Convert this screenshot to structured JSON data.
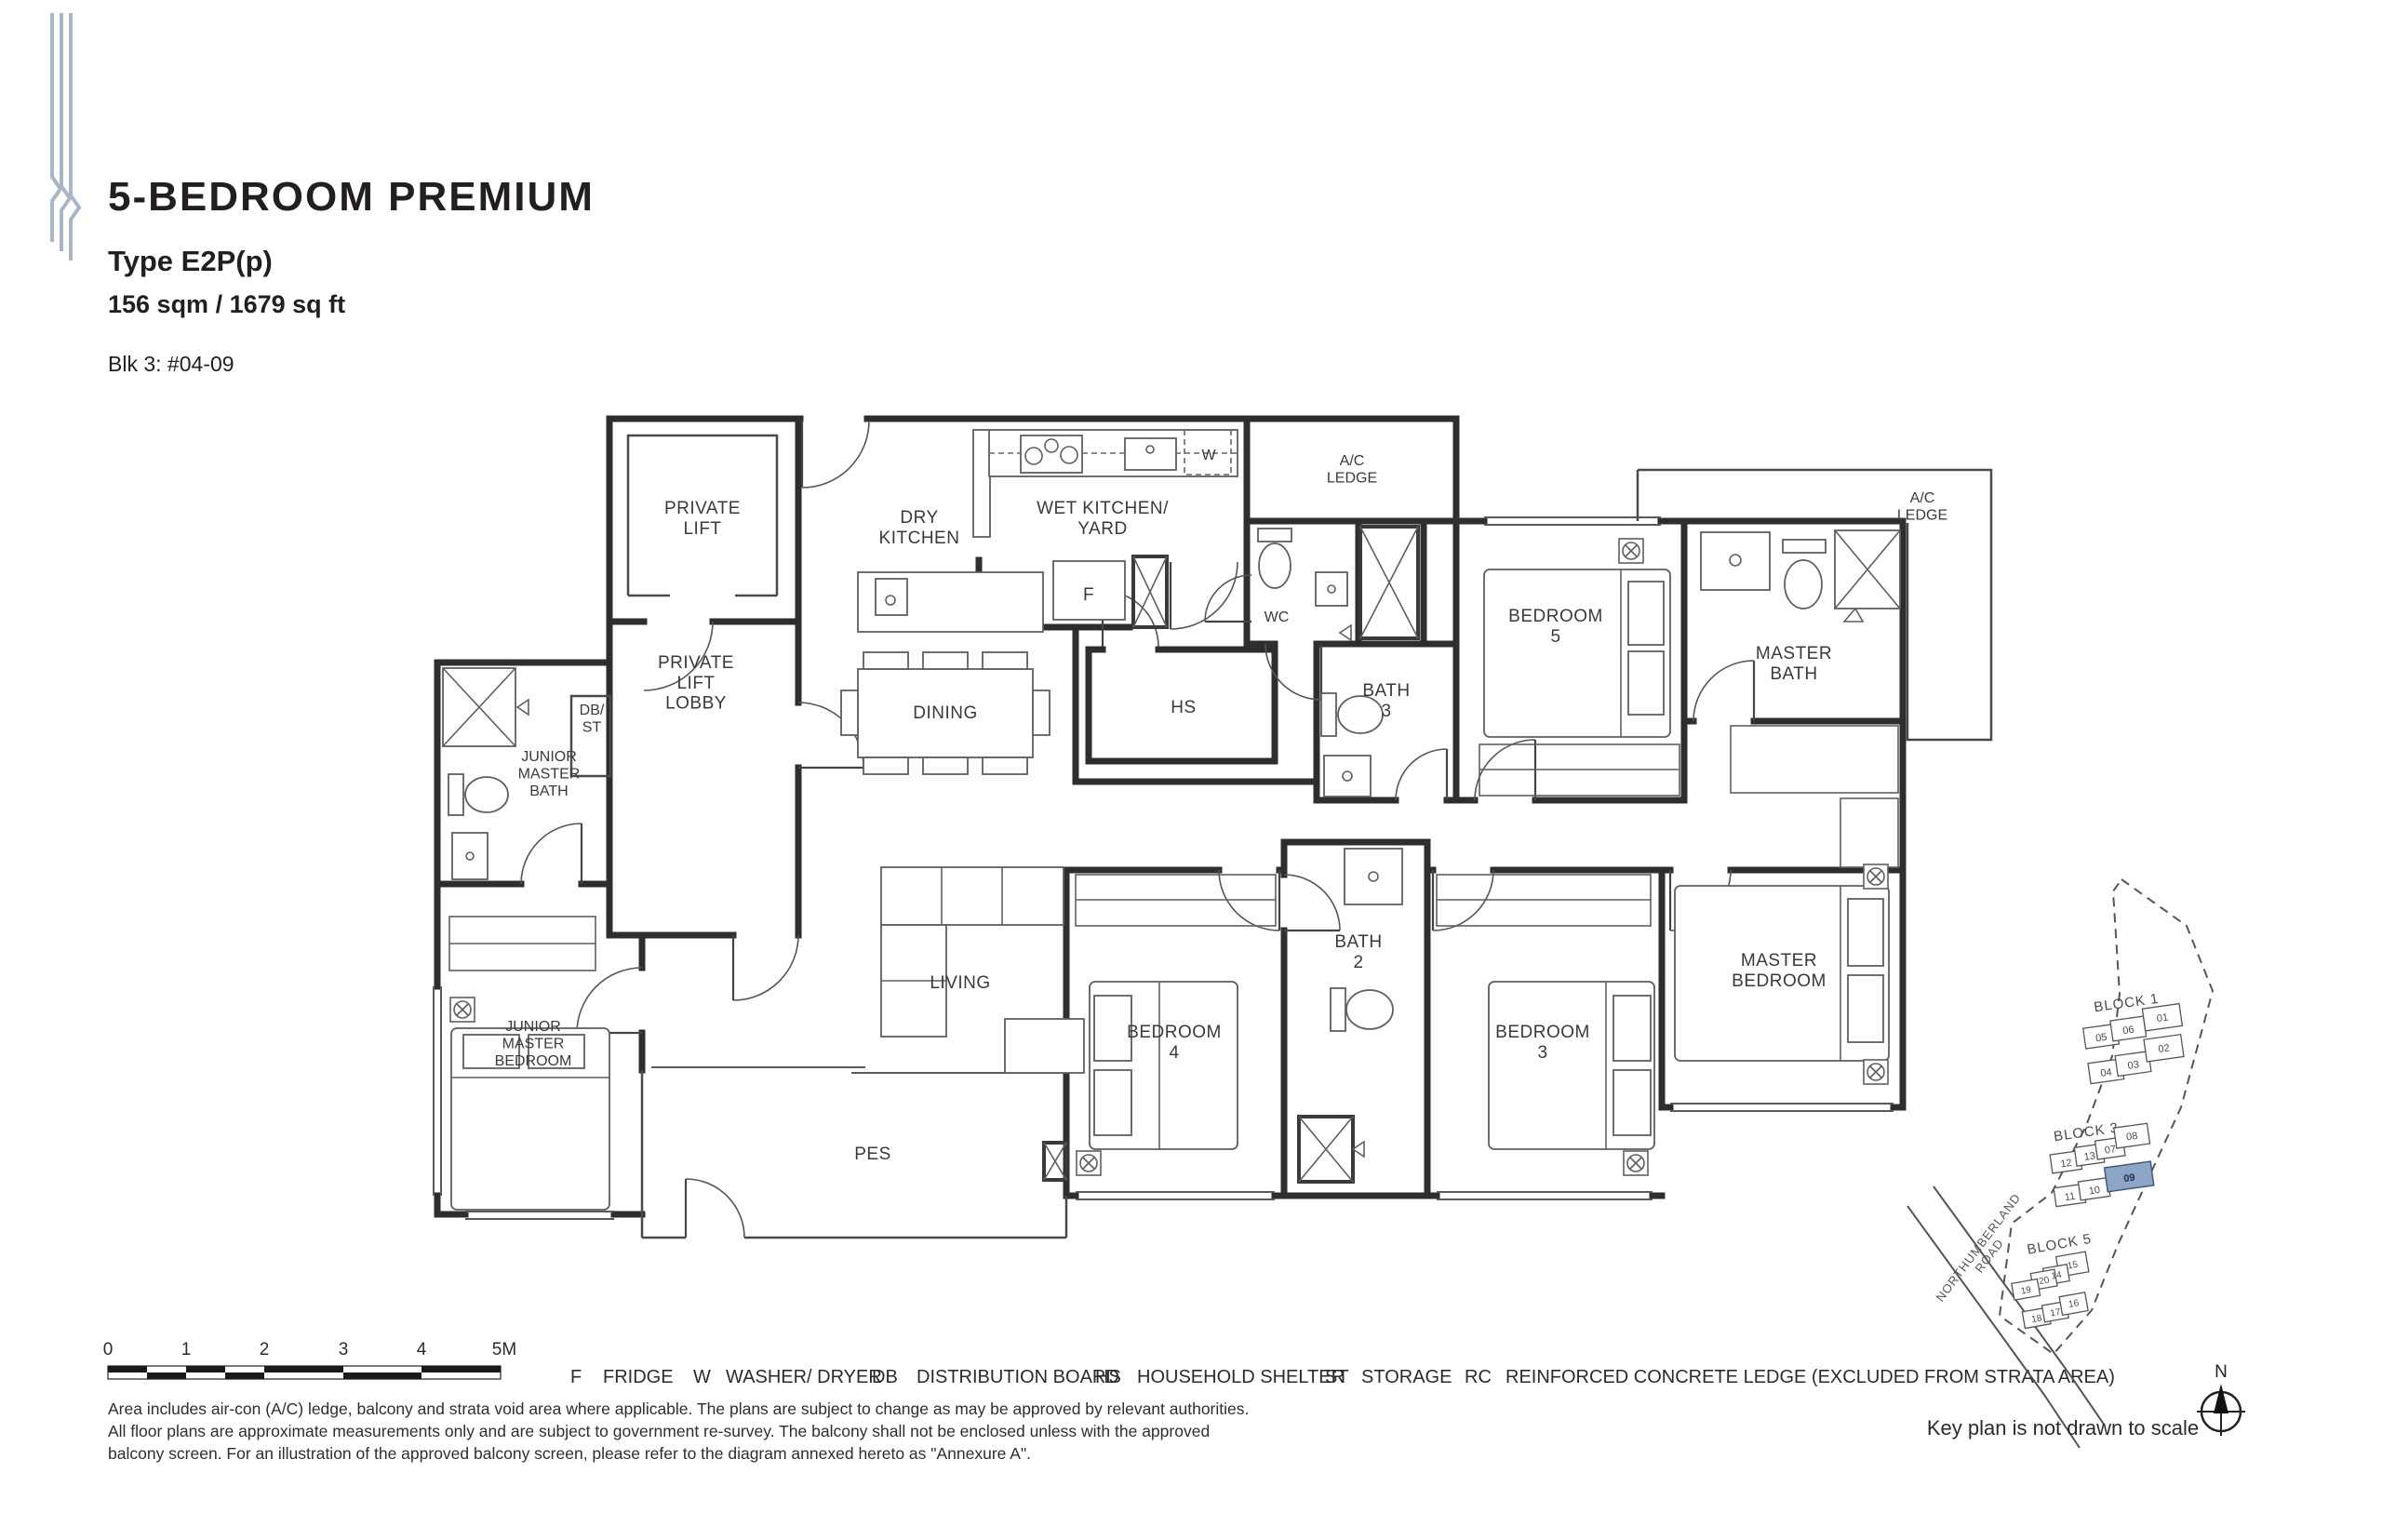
{
  "header": {
    "title": "5-BEDROOM PREMIUM",
    "unit_type": "Type E2P(p)",
    "area": "156 sqm / 1679 sq ft",
    "unit_no": "Blk 3: #04-09"
  },
  "floorplan": {
    "rooms": {
      "private_lift": "PRIVATE\nLIFT",
      "private_lift_lobby": "PRIVATE\nLIFT\nLOBBY",
      "db_st": "DB/\nST",
      "dry_kitchen": "DRY\nKITCHEN",
      "wet_kitchen": "WET KITCHEN/\nYARD",
      "ac_ledge_top": "A/C\nLEDGE",
      "ac_ledge_right": "A/C\nLEDGE",
      "wc": "WC",
      "bath3": "BATH\n3",
      "bedroom5": "BEDROOM\n5",
      "master_bath": "MASTER\nBATH",
      "dining": "DINING",
      "hs": "HS",
      "junior_master_bath": "JUNIOR\nMASTER\nBATH",
      "junior_master_bedroom": "JUNIOR\nMASTER\nBEDROOM",
      "living": "LIVING",
      "bedroom4": "BEDROOM\n4",
      "bath2": "BATH\n2",
      "bedroom3": "BEDROOM\n3",
      "master_bedroom": "MASTER\nBEDROOM",
      "pes": "PES",
      "fridge": "F",
      "washer": "W"
    }
  },
  "scale_bar": {
    "ticks": [
      "0",
      "1",
      "2",
      "3",
      "4",
      "5M"
    ]
  },
  "legend": {
    "items": [
      {
        "abbr": "F",
        "label": "FRIDGE"
      },
      {
        "abbr": "W",
        "label": "WASHER/ DRYER"
      },
      {
        "abbr": "DB",
        "label": "DISTRIBUTION BOARD"
      },
      {
        "abbr": "HS",
        "label": "HOUSEHOLD SHELTER"
      },
      {
        "abbr": "ST",
        "label": "STORAGE"
      },
      {
        "abbr": "RC",
        "label": "REINFORCED CONCRETE LEDGE (EXCLUDED FROM STRATA AREA)"
      }
    ]
  },
  "disclaimer": {
    "lines": [
      "Area includes air-con (A/C) ledge, balcony and strata void area where applicable. The plans are subject to change as may be approved by relevant authorities.",
      "All floor plans are approximate measurements only and are subject to government re-survey. The balcony shall not be enclosed unless with the approved",
      "balcony screen. For an illustration of the approved balcony screen, please refer to the diagram annexed hereto as \"Annexure A\"."
    ]
  },
  "key_plan": {
    "blocks": [
      {
        "name": "BLOCK 1",
        "units": [
          "05",
          "06",
          "01",
          "04",
          "03",
          "02"
        ]
      },
      {
        "name": "BLOCK 3",
        "units": [
          "12",
          "13",
          "07",
          "08",
          "11",
          "10",
          "09"
        ]
      },
      {
        "name": "BLOCK 5",
        "units": [
          "15",
          "14",
          "20",
          "19",
          "18",
          "17",
          "16"
        ]
      }
    ],
    "highlighted_unit": "09",
    "highlight_color": "#8da5c6",
    "road": "NORTHUMBERLAND\nROAD",
    "note": "Key plan is not drawn to scale",
    "compass_north": "N"
  }
}
